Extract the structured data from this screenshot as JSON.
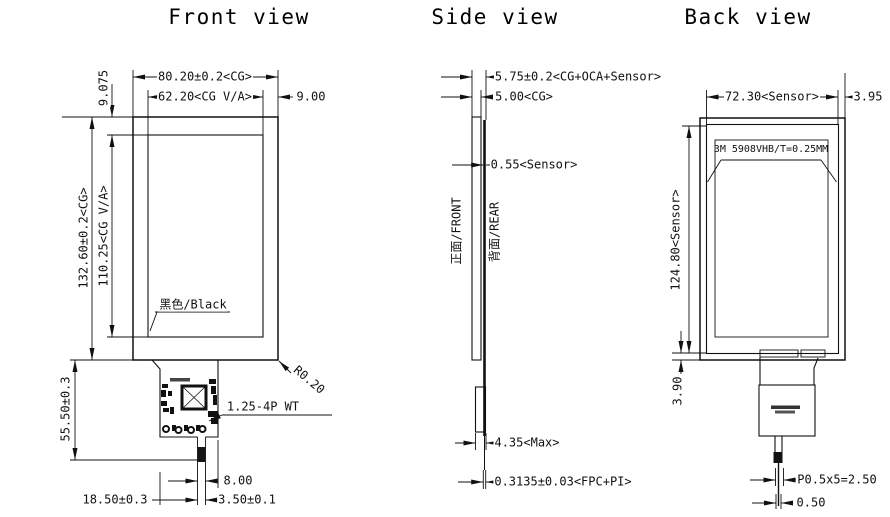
{
  "front": {
    "title": "Front view",
    "dim_top_bezel": "9.075",
    "dim_cg_width": "80.20±0.2<CG>",
    "dim_va_width": "62.20<CG V/A>",
    "dim_right_margin": "9.00",
    "dim_cg_height": "132.60±0.2<CG>",
    "dim_va_height": "110.25<CG V/A>",
    "label_bezel_color": "黑色/Black",
    "label_corner_radius": "R0.20",
    "dim_tail_length": "55.50±0.3",
    "label_connector": "1.25-4P WT",
    "dim_tail_width": "8.00",
    "dim_fpc_left": "18.50±0.3",
    "dim_fpc_width": "3.50±0.1"
  },
  "side": {
    "title": "Side view",
    "dim_total_thickness": "5.75±0.2<CG+OCA+Sensor>",
    "dim_cg_thickness": "5.00<CG>",
    "dim_sensor_thickness": "0.55<Sensor>",
    "label_front_face": "正面/FRONT",
    "label_rear_face": "背面/REAR",
    "dim_max_thickness": "4.35<Max>",
    "dim_fpc_thickness": "0.3135±0.03<FPC+PI>"
  },
  "back": {
    "title": "Back view",
    "dim_sensor_width": "72.30<Sensor>",
    "dim_right_margin": "3.95",
    "label_adhesive": "3M 5908VHB/T=0.25MM",
    "dim_sensor_height": "124.80<Sensor>",
    "dim_bottom_margin": "3.90",
    "dim_pin_pitch": "P0.5x5=2.50",
    "dim_fpc_end": "0.50"
  }
}
